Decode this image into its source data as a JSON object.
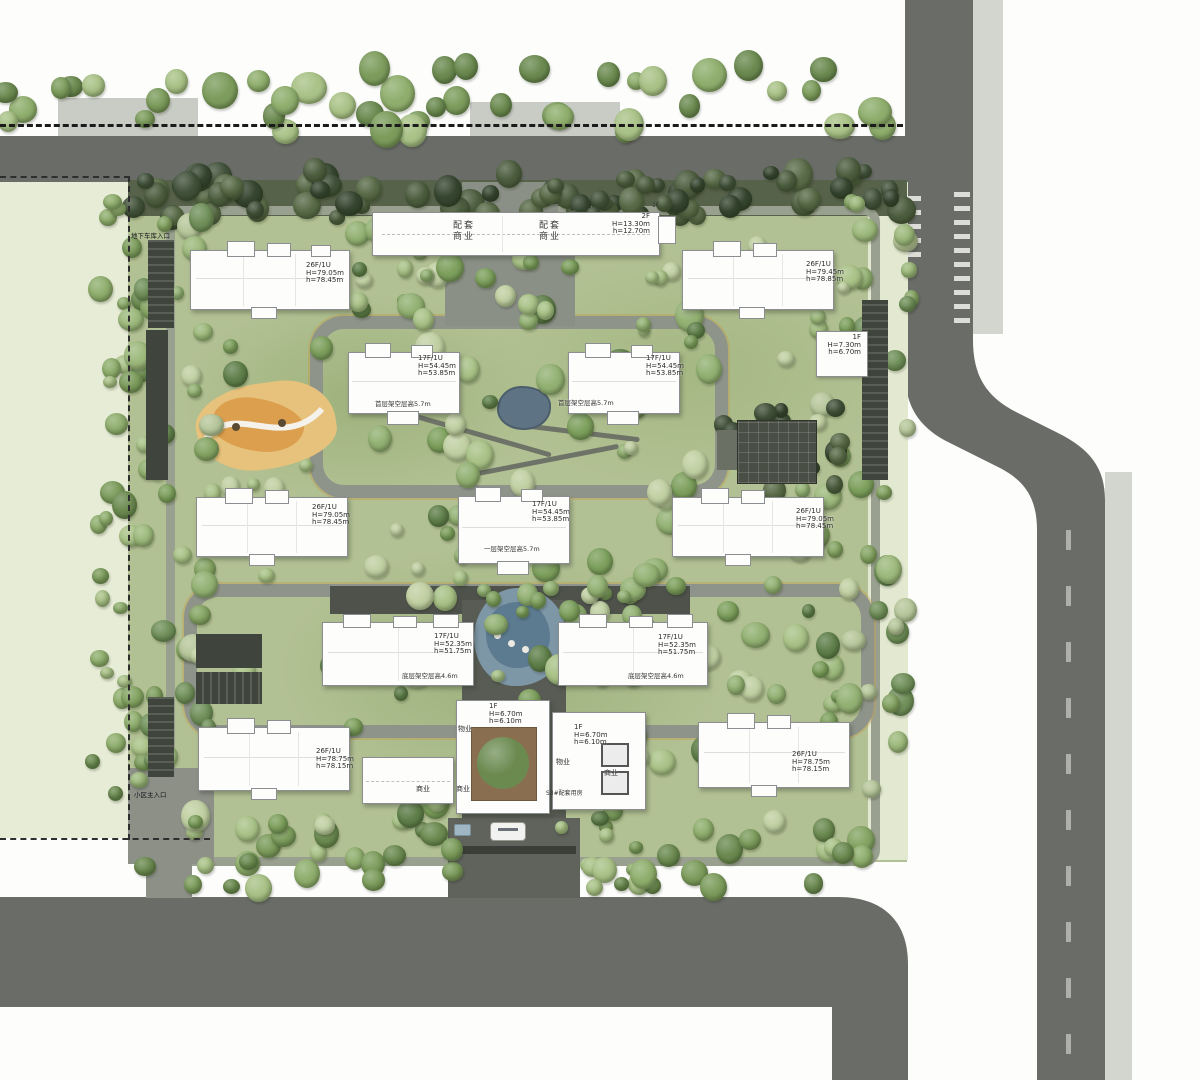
{
  "annotations": {
    "underground_garage_entrance": "地下车库入口",
    "community_main_entrance": "小区主入口"
  },
  "north_retail": {
    "unit_left": {
      "lines": [
        "配套",
        "商业"
      ]
    },
    "unit_right": {
      "lines": [
        "配套",
        "商业"
      ]
    },
    "info": {
      "lines": [
        "2F",
        "H=13.30m",
        "h=12.70m"
      ]
    },
    "floor_tag": "1F"
  },
  "towers": {
    "nw": {
      "lines": [
        "26F/1U",
        "H=79.05m",
        "h=78.45m"
      ]
    },
    "ne": {
      "lines": [
        "26F/1U",
        "H=79.45m",
        "h=78.85m"
      ]
    },
    "w": {
      "lines": [
        "26F/1U",
        "H=79.05m",
        "h=78.45m"
      ]
    },
    "e": {
      "lines": [
        "26F/1U",
        "H=79.05m",
        "h=78.45m"
      ]
    },
    "sw": {
      "lines": [
        "26F/1U",
        "H=78.75m",
        "h=78.15m"
      ]
    },
    "se": {
      "lines": [
        "26F/1U",
        "H=78.75m",
        "h=78.15m"
      ]
    },
    "mid_nw": {
      "lines": [
        "17F/1U",
        "H=54.45m",
        "h=53.85m"
      ],
      "note": "首层架空层高5.7m"
    },
    "mid_ne": {
      "lines": [
        "17F/1U",
        "H=54.45m",
        "h=53.85m"
      ],
      "note": "首层架空层高5.7m"
    },
    "mid_c": {
      "lines": [
        "17F/1U",
        "H=54.45m",
        "h=53.85m"
      ],
      "note": "一层架空层高5.7m"
    },
    "mid_sw": {
      "lines": [
        "17F/1U",
        "H=52.35m",
        "h=51.75m"
      ],
      "note": "底层架空层高4.6m"
    },
    "mid_se": {
      "lines": [
        "17F/1U",
        "H=52.35m",
        "h=51.75m"
      ],
      "note": "底层架空层高4.6m"
    }
  },
  "south_retail": {
    "center_info": {
      "lines": [
        "1F",
        "H=6.70m",
        "h=6.10m"
      ]
    },
    "east_info": {
      "lines": [
        "1F",
        "H=6.70m",
        "h=6.10m"
      ]
    },
    "property_west": "物业",
    "property_east": "物业",
    "biz_west": "商业",
    "biz_center": "商业",
    "biz_east": "商业",
    "s3_name": "S3#配套用房"
  },
  "east_kiosk": {
    "lines": [
      "1F",
      "H=7.30m",
      "h=6.70m"
    ]
  },
  "colors": {
    "road": "#696c67",
    "sidewalk": "#d3d6cf",
    "lawn": "#b2c193",
    "parcel": "#e7ecd6",
    "water": "#5d7b90",
    "playground": "#dc9f4e"
  }
}
